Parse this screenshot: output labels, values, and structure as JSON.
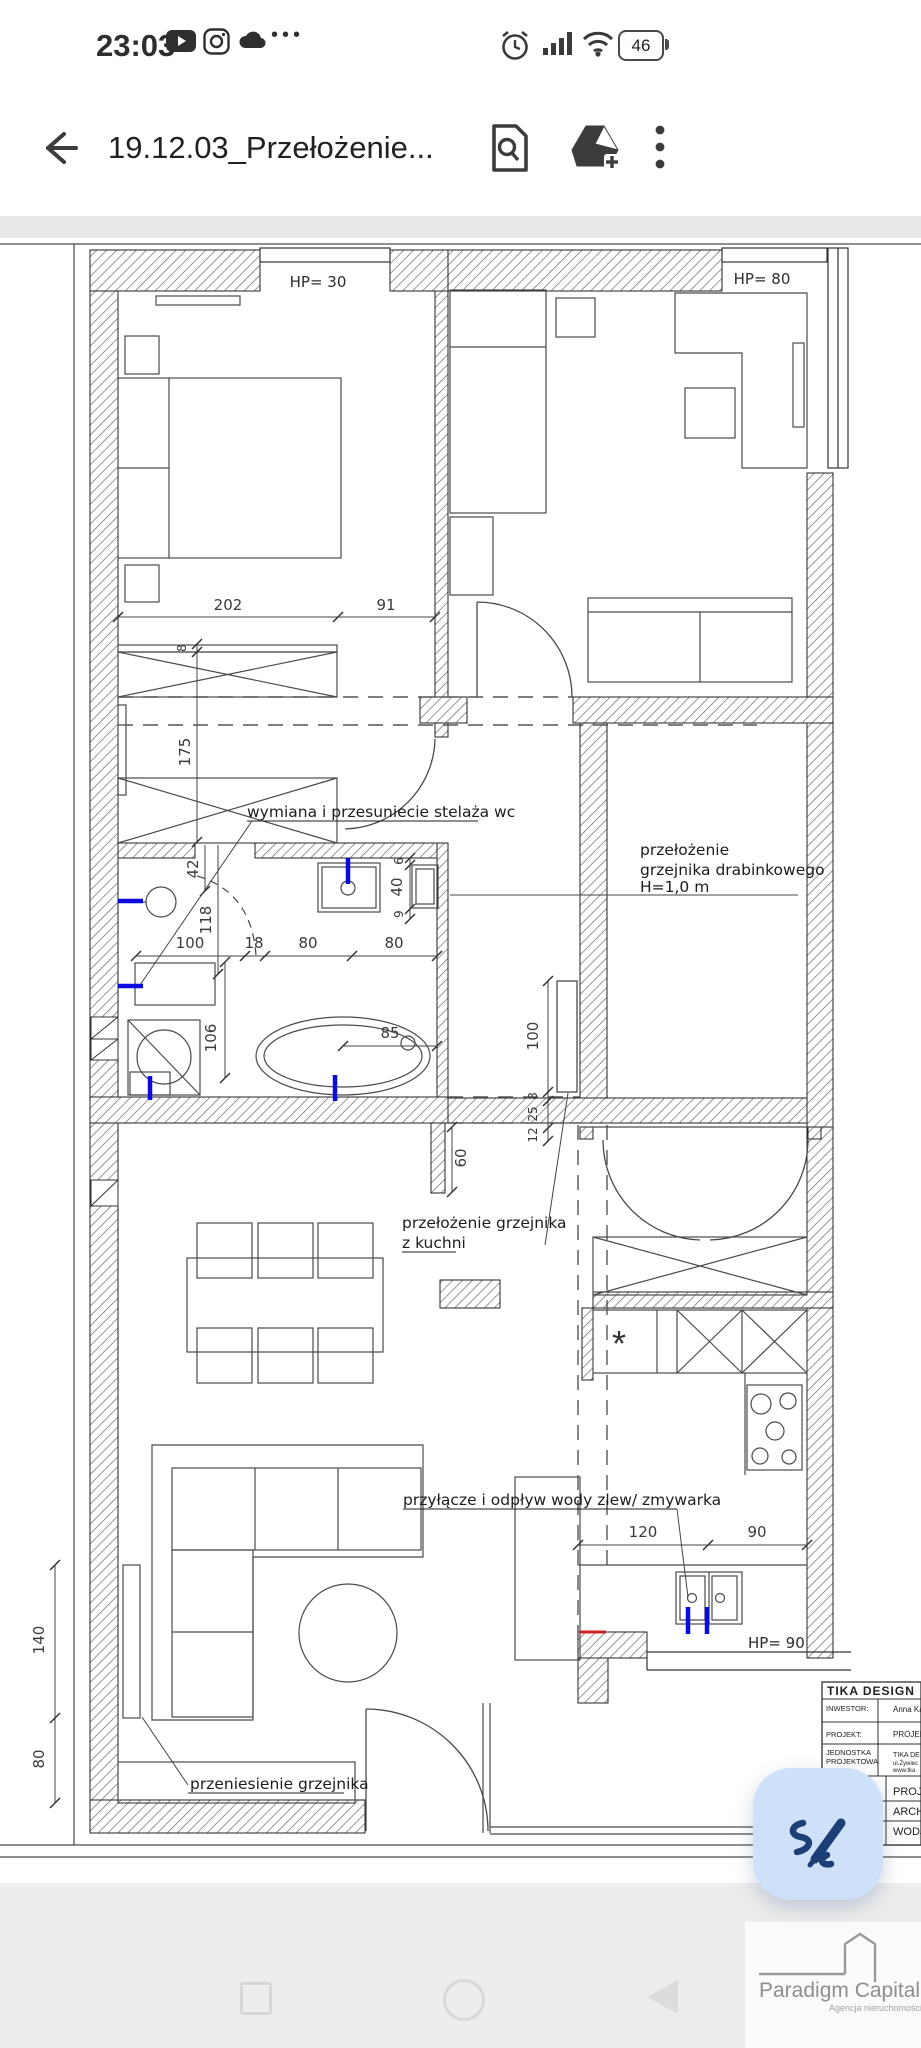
{
  "status_bar": {
    "time": "23:03",
    "battery_percent": "46",
    "more_glyph": "•••"
  },
  "toolbar": {
    "title": "19.12.03_Przełożenie..."
  },
  "plan": {
    "windows": {
      "hp30": "HP= 30",
      "hp80": "HP= 80",
      "hp90": "HP= 90"
    },
    "annotations": {
      "wc": "wymiana i przesuniecie stelaża wc",
      "towel_radiator": [
        "przełożenie",
        "grzejnika drabinkowego",
        "H=1,0 m"
      ],
      "kitchen_radiator": [
        "przełożenie grzejnika",
        "z kuchni"
      ],
      "water": "przyłącze i odpływ wody zlew/ zmywarka",
      "radiator_move": "przeniesienie grzejnika"
    },
    "dims": {
      "d202": "202",
      "d91": "91",
      "d175": "175",
      "d8a": "8",
      "d42": "42",
      "d118": "118",
      "d100a": "100",
      "d18": "18",
      "d80a": "80",
      "d80b": "80",
      "d6": "6",
      "d40": "40",
      "d9": "9",
      "d106": "106",
      "d85": "85",
      "d60": "60",
      "d100b": "100",
      "d8b": "8",
      "d25": "25",
      "d12": "12",
      "d120": "120",
      "d90": "90",
      "d140": "140",
      "d80c": "80",
      "fridge_mark": "*"
    }
  },
  "title_block": {
    "company": "TIKA DESIGN",
    "row1_label": "INWESTOR:",
    "row1_value": "Anna Ka",
    "row2_label": "PROJEKT:",
    "row2_value": "PROJEK",
    "row3_label": "JEDNOSTKA",
    "row3_label2": "PROJEKTOWA",
    "row3_value": "TIKA DE",
    "row3_value2": "ul.Żywiec",
    "row3_value3": "www.tka",
    "section1": "PROJE",
    "section2": "ARCH",
    "section3": "WODJ"
  },
  "watermark": {
    "name": "Paradigm Capital",
    "tagline": "Agencja nieruchomości"
  },
  "colors": {
    "accent_fab": "#cfe1f8",
    "fab_icon": "#1d3f77",
    "plumbing_blue": "#0b0be0",
    "mark_red": "#cc2222"
  }
}
